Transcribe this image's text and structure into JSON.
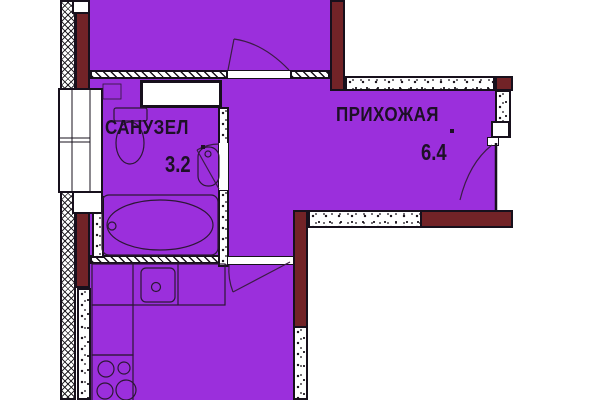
{
  "plan": {
    "name": "apartment-floor-plan",
    "rooms": [
      {
        "id": "sanuzel",
        "label": "САНУЗЕЛ",
        "area": "3.2"
      },
      {
        "id": "prihozhaya",
        "label": "ПРИХОЖАЯ",
        "area": "6.4"
      }
    ],
    "fixtures": [
      "window-icon",
      "bathtub-icon",
      "toilet-icon",
      "washbasin-icon",
      "kitchen-counter-icon",
      "kitchen-sink-icon",
      "stove-icon",
      "door-swing-icon",
      "ventilation-shaft-icon"
    ],
    "colors": {
      "room_fill": "#9B2FDC",
      "wall_brick": "#722327",
      "outline": "#17101c",
      "text": "#1d1026",
      "background": "#ffffff"
    }
  }
}
